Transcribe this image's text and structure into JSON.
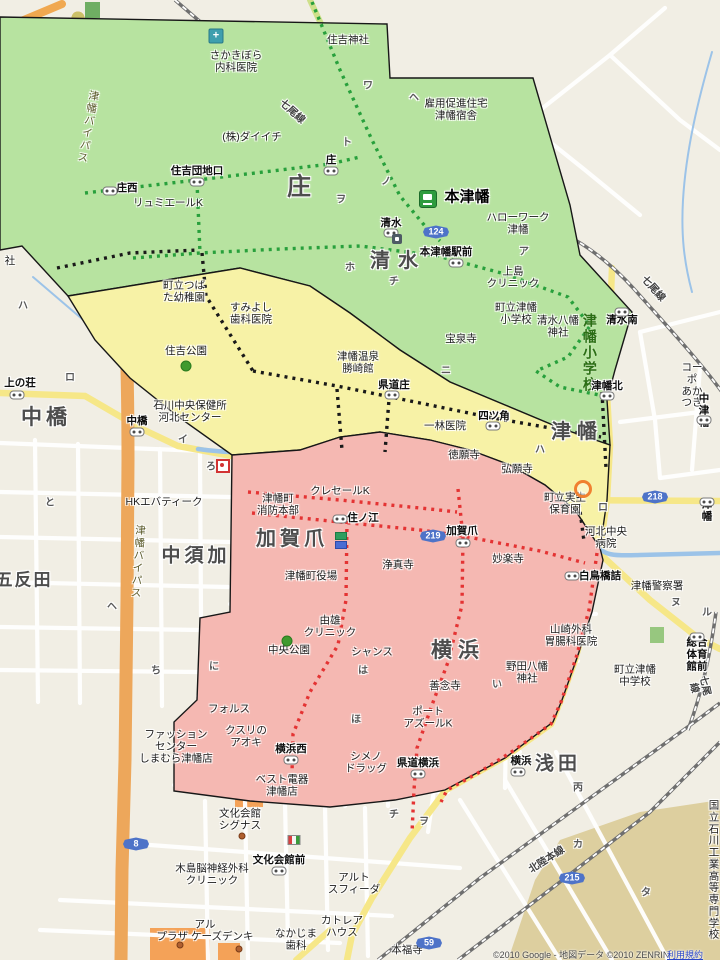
{
  "map": {
    "background": "#f1eee4",
    "zone_colors": {
      "green": "#b7e3a0",
      "yellow": "#f7f2a6",
      "pink": "#f5b8b2",
      "outline": "#171717"
    },
    "route_dot_colors": {
      "green_route": "#28a03c",
      "black_route": "#191919",
      "red_route": "#e43333"
    },
    "copyright": {
      "text": "©2010 Google - 地図データ ©2010 ZENRIN ",
      "link": "利用規約"
    },
    "labels": [
      {
        "t": "さかきぼら\n内科医院",
        "x": 236,
        "y": 62,
        "cls": "poi"
      },
      {
        "t": "住吉神社",
        "x": 348,
        "y": 41,
        "cls": "poi"
      },
      {
        "t": "雇用促進住宅\n津幡宿舎",
        "x": 456,
        "y": 110,
        "cls": "poi"
      },
      {
        "t": "(株)ダイイチ",
        "x": 252,
        "y": 138,
        "cls": "poi"
      },
      {
        "t": "リュミエールK",
        "x": 168,
        "y": 204,
        "cls": "poi"
      },
      {
        "t": "住吉団地口",
        "x": 197,
        "y": 172,
        "cls": "busstop"
      },
      {
        "t": "庄西",
        "x": 127,
        "y": 189,
        "cls": "busstop"
      },
      {
        "t": "庄",
        "x": 331,
        "y": 161,
        "cls": "busstop"
      },
      {
        "t": "庄",
        "x": 300,
        "y": 188,
        "cls": "district",
        "sz": 24,
        "ls": 2
      },
      {
        "t": "本津幡",
        "x": 467,
        "y": 198,
        "cls": "stationname"
      },
      {
        "t": "ハローワーク\n津幡",
        "x": 518,
        "y": 224,
        "cls": "poi"
      },
      {
        "t": "本津幡駅前",
        "x": 446,
        "y": 253,
        "cls": "busstop"
      },
      {
        "t": "清水",
        "x": 391,
        "y": 224,
        "cls": "busstop"
      },
      {
        "t": "清水",
        "x": 398,
        "y": 261,
        "cls": "district",
        "sz": 20,
        "ls": 8
      },
      {
        "t": "上島\nクリニック",
        "x": 513,
        "y": 278,
        "cls": "poi"
      },
      {
        "t": "町立津幡\n小学校",
        "x": 516,
        "y": 314,
        "cls": "poi"
      },
      {
        "t": "清水八幡\n神社",
        "x": 558,
        "y": 327,
        "cls": "poi"
      },
      {
        "t": "津幡小学校",
        "x": 589,
        "y": 353,
        "cls": "school-v"
      },
      {
        "t": "清水南",
        "x": 622,
        "y": 321,
        "cls": "busstop"
      },
      {
        "t": "津幡北",
        "x": 607,
        "y": 387,
        "cls": "busstop"
      },
      {
        "t": "宝泉寺",
        "x": 461,
        "y": 340,
        "cls": "poi"
      },
      {
        "t": "町立つば\nた幼稚園",
        "x": 184,
        "y": 292,
        "cls": "poi"
      },
      {
        "t": "すみよし\n歯科医院",
        "x": 251,
        "y": 314,
        "cls": "poi"
      },
      {
        "t": "住吉公園",
        "x": 186,
        "y": 352,
        "cls": "poi"
      },
      {
        "t": "津幡温泉\n勝崎館",
        "x": 358,
        "y": 363,
        "cls": "poi"
      },
      {
        "t": "県道庄",
        "x": 394,
        "y": 386,
        "cls": "busstop"
      },
      {
        "t": "石川中央保健所\n河北センター",
        "x": 190,
        "y": 412,
        "cls": "poi"
      },
      {
        "t": "四ツ角",
        "x": 494,
        "y": 417,
        "cls": "busstop"
      },
      {
        "t": "一林医院",
        "x": 445,
        "y": 427,
        "cls": "poi"
      },
      {
        "t": "徳願寺",
        "x": 464,
        "y": 456,
        "cls": "poi"
      },
      {
        "t": "弘願寺",
        "x": 517,
        "y": 470,
        "cls": "poi"
      },
      {
        "t": "津幡",
        "x": 577,
        "y": 432,
        "cls": "district",
        "sz": 20,
        "ls": 6
      },
      {
        "t": "コーポ\nあかつき",
        "x": 692,
        "y": 386,
        "cls": "poi"
      },
      {
        "t": "中津幡",
        "x": 704,
        "y": 411,
        "cls": "busstop"
      },
      {
        "t": "上の荘",
        "x": 20,
        "y": 384,
        "cls": "busstop"
      },
      {
        "t": "中橋",
        "x": 46,
        "y": 418,
        "cls": "district",
        "sz": 21,
        "ls": 4
      },
      {
        "t": "中橋",
        "x": 137,
        "y": 422,
        "cls": "busstop"
      },
      {
        "t": "HKエバティーク",
        "x": 164,
        "y": 503,
        "cls": "poi"
      },
      {
        "t": "中須加",
        "x": 196,
        "y": 556,
        "cls": "district",
        "sz": 19,
        "ls": 4
      },
      {
        "t": "五反田",
        "x": 24,
        "y": 580,
        "cls": "district",
        "sz": 17,
        "ls": 2
      },
      {
        "t": "クレセールK",
        "x": 340,
        "y": 492,
        "cls": "poi"
      },
      {
        "t": "津幡町\n消防本部",
        "x": 278,
        "y": 505,
        "cls": "poi"
      },
      {
        "t": "加賀爪",
        "x": 292,
        "y": 539,
        "cls": "district",
        "sz": 20,
        "ls": 4
      },
      {
        "t": "津幡町役場",
        "x": 311,
        "y": 577,
        "cls": "poi"
      },
      {
        "t": "由雄\nクリニック",
        "x": 330,
        "y": 627,
        "cls": "poi"
      },
      {
        "t": "中央公園",
        "x": 289,
        "y": 651,
        "cls": "poi"
      },
      {
        "t": "住ノ江",
        "x": 363,
        "y": 519,
        "cls": "busstop"
      },
      {
        "t": "加賀爪",
        "x": 462,
        "y": 532,
        "cls": "busstop"
      },
      {
        "t": "浄真寺",
        "x": 398,
        "y": 566,
        "cls": "poi"
      },
      {
        "t": "妙楽寺",
        "x": 508,
        "y": 560,
        "cls": "poi"
      },
      {
        "t": "町立実生\n保育園",
        "x": 565,
        "y": 504,
        "cls": "poi"
      },
      {
        "t": "河北中央\n病院",
        "x": 606,
        "y": 538,
        "cls": "poi"
      },
      {
        "t": "白鳥橋詰",
        "x": 600,
        "y": 577,
        "cls": "busstop"
      },
      {
        "t": "津幡警察署",
        "x": 657,
        "y": 587,
        "cls": "poi"
      },
      {
        "t": "津幡",
        "x": 707,
        "y": 511,
        "cls": "busstop"
      },
      {
        "t": "山崎外科\n胃腸科医院",
        "x": 571,
        "y": 636,
        "cls": "poi"
      },
      {
        "t": "野田八幡\n神社",
        "x": 527,
        "y": 673,
        "cls": "poi"
      },
      {
        "t": "善念寺",
        "x": 445,
        "y": 687,
        "cls": "poi"
      },
      {
        "t": "横浜",
        "x": 458,
        "y": 651,
        "cls": "district",
        "sz": 21,
        "ls": 6
      },
      {
        "t": "シャンス",
        "x": 372,
        "y": 653,
        "cls": "poi"
      },
      {
        "t": "町立津幡\n中学校",
        "x": 635,
        "y": 676,
        "cls": "poi"
      },
      {
        "t": "総合\n体育館前",
        "x": 697,
        "y": 655,
        "cls": "busstop"
      },
      {
        "t": "フォルス",
        "x": 229,
        "y": 710,
        "cls": "poi"
      },
      {
        "t": "クスリの\nアオキ",
        "x": 246,
        "y": 737,
        "cls": "poi"
      },
      {
        "t": "横浜西",
        "x": 291,
        "y": 750,
        "cls": "busstop"
      },
      {
        "t": "ベスト電器\n津幡店",
        "x": 282,
        "y": 786,
        "cls": "poi"
      },
      {
        "t": "ファッション\nセンター\nしまむら津幡店",
        "x": 176,
        "y": 747,
        "cls": "poi"
      },
      {
        "t": "ポート\nアズールK",
        "x": 428,
        "y": 718,
        "cls": "poi"
      },
      {
        "t": "シメノ\nドラッグ",
        "x": 366,
        "y": 763,
        "cls": "poi"
      },
      {
        "t": "県道横浜",
        "x": 418,
        "y": 764,
        "cls": "busstop"
      },
      {
        "t": "横浜",
        "x": 521,
        "y": 762,
        "cls": "busstop"
      },
      {
        "t": "浅田",
        "x": 558,
        "y": 764,
        "cls": "district",
        "sz": 19,
        "ls": 4
      },
      {
        "t": "文化会館\nシグナス",
        "x": 240,
        "y": 820,
        "cls": "poi"
      },
      {
        "t": "文化会館前",
        "x": 279,
        "y": 861,
        "cls": "busstop"
      },
      {
        "t": "木島脳神経外科\nクリニック",
        "x": 212,
        "y": 875,
        "cls": "poi"
      },
      {
        "t": "アルト\nスフィーダ",
        "x": 354,
        "y": 884,
        "cls": "poi"
      },
      {
        "t": "アル\nプラザ ケーズデンキ",
        "x": 205,
        "y": 931,
        "cls": "poi"
      },
      {
        "t": "なかじま\n歯科",
        "x": 296,
        "y": 940,
        "cls": "poi"
      },
      {
        "t": "カトレア\nハウス",
        "x": 342,
        "y": 927,
        "cls": "poi"
      },
      {
        "t": "本福寺",
        "x": 407,
        "y": 951,
        "cls": "poi"
      },
      {
        "t": "国立石川工業\n高等専門学校",
        "x": 714,
        "y": 871,
        "cls": "poi"
      },
      {
        "t": "社",
        "x": 10,
        "y": 262,
        "cls": "poi"
      },
      {
        "t": "津幡バイパス",
        "x": 87,
        "y": 127,
        "cls": "roadv",
        "rot": 10
      },
      {
        "t": "津幡バイパス",
        "x": 137,
        "y": 562,
        "cls": "roadv",
        "rot": 4
      },
      {
        "t": "七尾線",
        "x": 292,
        "y": 112,
        "cls": "rail",
        "rot": 42
      },
      {
        "t": "七尾線",
        "x": 653,
        "y": 289,
        "cls": "rail",
        "rot": 48
      },
      {
        "t": "七尾線",
        "x": 699,
        "y": 687,
        "cls": "rail",
        "rot": 78
      },
      {
        "t": "北陸本線",
        "x": 547,
        "y": 860,
        "cls": "rail",
        "rot": -33
      },
      {
        "t": "ワ",
        "x": 368,
        "y": 86,
        "cls": "kana"
      },
      {
        "t": "ヘ",
        "x": 414,
        "y": 98,
        "cls": "kana"
      },
      {
        "t": "ホ",
        "x": 350,
        "y": 268,
        "cls": "kana"
      },
      {
        "t": "チ",
        "x": 394,
        "y": 282,
        "cls": "kana"
      },
      {
        "t": "ア",
        "x": 524,
        "y": 252,
        "cls": "kana"
      },
      {
        "t": "ニ",
        "x": 446,
        "y": 371,
        "cls": "kana"
      },
      {
        "t": "ハ",
        "x": 540,
        "y": 450,
        "cls": "kana"
      },
      {
        "t": "イ",
        "x": 183,
        "y": 440,
        "cls": "kana"
      },
      {
        "t": "ろ",
        "x": 211,
        "y": 467,
        "cls": "kana"
      },
      {
        "t": "ロ",
        "x": 603,
        "y": 508,
        "cls": "kana"
      },
      {
        "t": "ヌ",
        "x": 676,
        "y": 603,
        "cls": "kana"
      },
      {
        "t": "ル",
        "x": 707,
        "y": 613,
        "cls": "kana"
      },
      {
        "t": "ヘ",
        "x": 112,
        "y": 607,
        "cls": "kana"
      },
      {
        "t": "ち",
        "x": 156,
        "y": 671,
        "cls": "kana"
      },
      {
        "t": "と",
        "x": 50,
        "y": 503,
        "cls": "kana"
      },
      {
        "t": "に",
        "x": 214,
        "y": 667,
        "cls": "kana"
      },
      {
        "t": "い",
        "x": 497,
        "y": 685,
        "cls": "kana"
      },
      {
        "t": "丙",
        "x": 578,
        "y": 788,
        "cls": "kana"
      },
      {
        "t": "カ",
        "x": 578,
        "y": 845,
        "cls": "kana"
      },
      {
        "t": "タ",
        "x": 646,
        "y": 893,
        "cls": "kana"
      },
      {
        "t": "チ",
        "x": 394,
        "y": 815,
        "cls": "kana"
      },
      {
        "t": "ヲ",
        "x": 424,
        "y": 822,
        "cls": "kana"
      },
      {
        "t": "ほ",
        "x": 356,
        "y": 720,
        "cls": "kana"
      },
      {
        "t": "ハ",
        "x": 23,
        "y": 306,
        "cls": "kana"
      },
      {
        "t": "ロ",
        "x": 70,
        "y": 378,
        "cls": "kana"
      },
      {
        "t": "ヲ",
        "x": 341,
        "y": 200,
        "cls": "kana"
      },
      {
        "t": "ト",
        "x": 347,
        "y": 143,
        "cls": "kana"
      },
      {
        "t": "ノ",
        "x": 386,
        "y": 182,
        "cls": "kana"
      },
      {
        "t": "は",
        "x": 363,
        "y": 671,
        "cls": "kana"
      }
    ],
    "bus_stops": [
      {
        "x": 110,
        "y": 191
      },
      {
        "x": 197,
        "y": 182
      },
      {
        "x": 331,
        "y": 171
      },
      {
        "x": 456,
        "y": 263
      },
      {
        "x": 391,
        "y": 233
      },
      {
        "x": 622,
        "y": 312
      },
      {
        "x": 607,
        "y": 396
      },
      {
        "x": 392,
        "y": 395
      },
      {
        "x": 493,
        "y": 426
      },
      {
        "x": 17,
        "y": 395
      },
      {
        "x": 137,
        "y": 432
      },
      {
        "x": 704,
        "y": 420
      },
      {
        "x": 340,
        "y": 519
      },
      {
        "x": 463,
        "y": 543
      },
      {
        "x": 572,
        "y": 576
      },
      {
        "x": 707,
        "y": 502
      },
      {
        "x": 697,
        "y": 637
      },
      {
        "x": 291,
        "y": 760
      },
      {
        "x": 418,
        "y": 774
      },
      {
        "x": 518,
        "y": 772
      },
      {
        "x": 279,
        "y": 871
      }
    ],
    "route_badges": [
      {
        "n": "124",
        "x": 436,
        "y": 232
      },
      {
        "n": "218",
        "x": 655,
        "y": 497
      },
      {
        "n": "219",
        "x": 433,
        "y": 536
      },
      {
        "n": "8",
        "x": 136,
        "y": 844
      },
      {
        "n": "59",
        "x": 429,
        "y": 943
      },
      {
        "n": "215",
        "x": 572,
        "y": 878
      }
    ],
    "icons": [
      {
        "t": "station",
        "x": 428,
        "y": 199,
        "name": "train-station-icon"
      },
      {
        "t": "hospital",
        "x": 216,
        "y": 36,
        "name": "hospital-icon",
        "glyph": "+"
      },
      {
        "t": "tree",
        "x": 287,
        "y": 641,
        "name": "park-tree-icon"
      },
      {
        "t": "tree",
        "x": 186,
        "y": 366,
        "name": "park-tree-icon"
      },
      {
        "t": "ring",
        "x": 583,
        "y": 489,
        "name": "kindergarten-marker-icon"
      },
      {
        "t": "redbox",
        "x": 223,
        "y": 466,
        "name": "poi-marker-icon"
      },
      {
        "t": "flag",
        "x": 294,
        "y": 840,
        "name": "hall-poi-icon"
      },
      {
        "t": "fuel",
        "x": 397,
        "y": 239,
        "name": "fuel-station-icon"
      },
      {
        "t": "chip-green",
        "x": 341,
        "y": 536,
        "name": "poi-chip-icon"
      },
      {
        "t": "chip-blue",
        "x": 341,
        "y": 545,
        "name": "poi-chip-icon"
      },
      {
        "t": "poidot",
        "x": 242,
        "y": 836,
        "name": "building-dot-icon"
      },
      {
        "t": "poidot",
        "x": 180,
        "y": 945,
        "name": "building-dot-icon"
      },
      {
        "t": "poidot",
        "x": 239,
        "y": 949,
        "name": "building-dot-icon"
      }
    ]
  }
}
